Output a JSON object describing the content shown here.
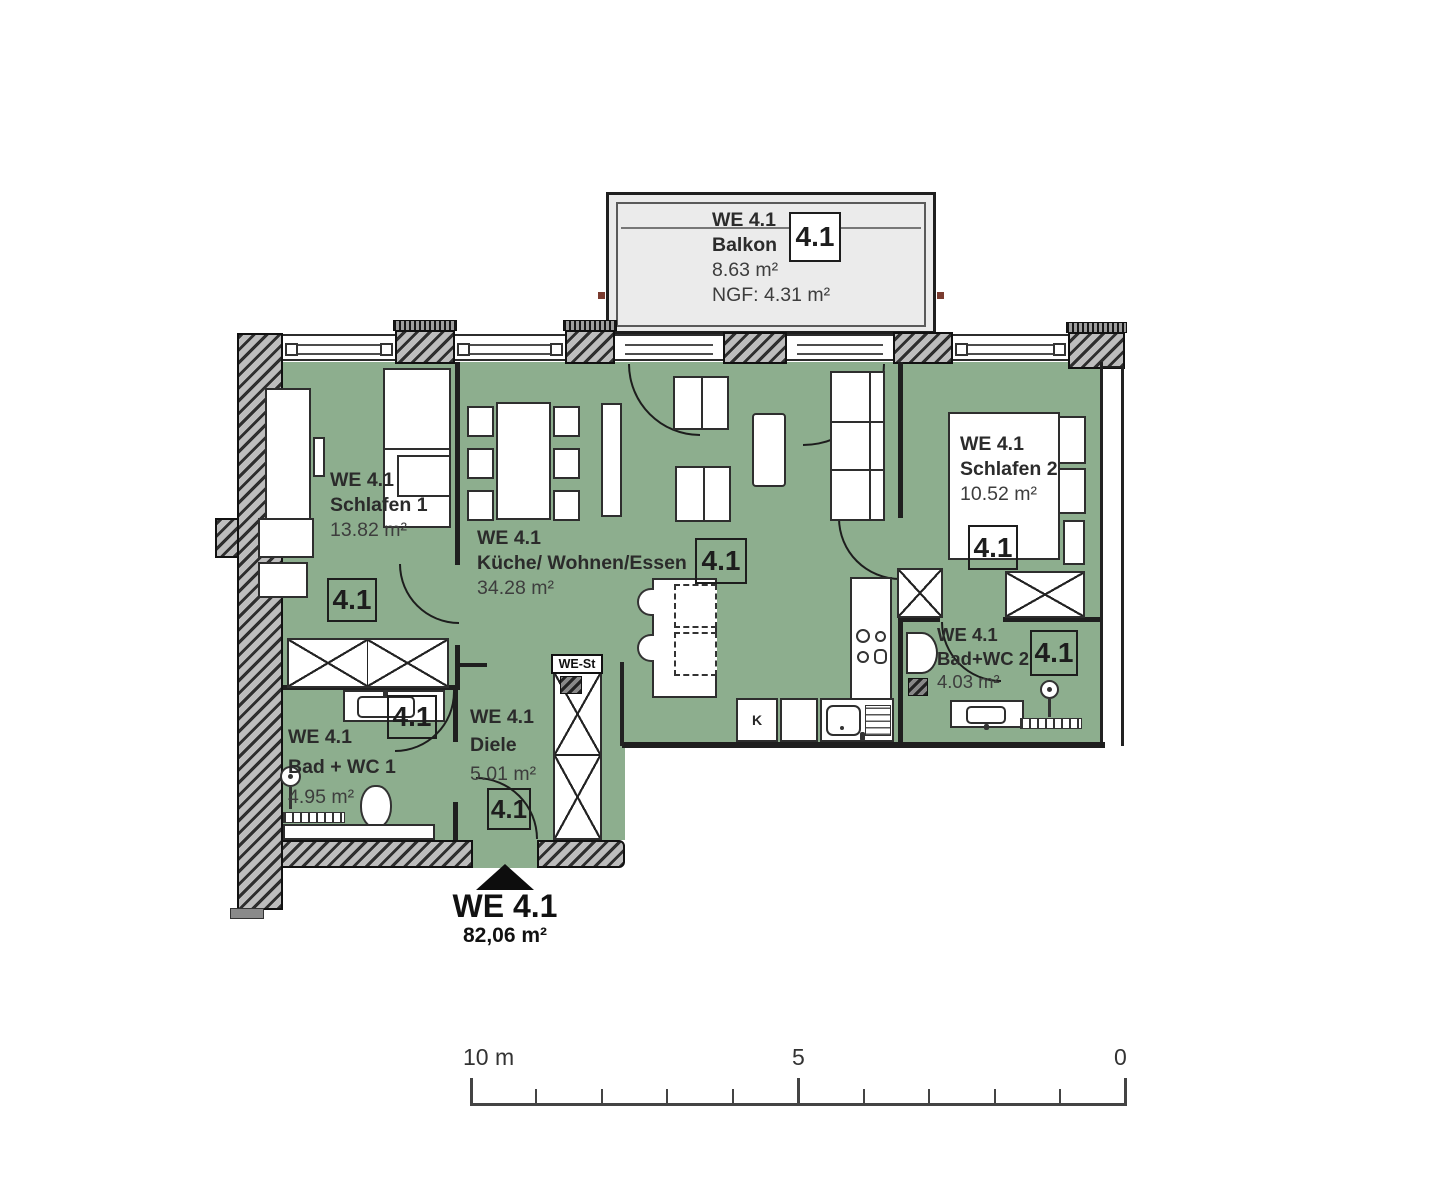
{
  "title": "Wohnung WE 4.1 Grundriss",
  "rooms": [
    {
      "we": "WE 4.1",
      "name": "Balkon",
      "area": "8.63 m²",
      "ngf": "NGF: 4.31 m²",
      "tag": "4.1"
    },
    {
      "we": "WE 4.1",
      "name": "Schlafen 1",
      "area": "13.82 m²",
      "tag": "4.1"
    },
    {
      "we": "WE 4.1",
      "name": "Küche/ Wohnen/Essen",
      "area": "34.28 m²",
      "tag": "4.1"
    },
    {
      "we": "WE 4.1",
      "name": "Schlafen 2",
      "area": "10.52 m²",
      "tag": "4.1"
    },
    {
      "we": "WE 4.1",
      "name": "Bad+WC 2",
      "area": "4.03 m²",
      "tag": "4.1"
    },
    {
      "we": "WE 4.1",
      "name": "Bad + WC 1",
      "area": "4.95 m²",
      "tag": "4.1"
    },
    {
      "we": "WE 4.1",
      "name": "Diele",
      "area": "5.01 m²",
      "tag": "4.1"
    }
  ],
  "entry": {
    "label": "WE 4.1",
    "area": "82,06 m²"
  },
  "annotations": {
    "shaft": "WE-St",
    "fridge": "K"
  },
  "scale": {
    "left": "10 m",
    "middle": "5",
    "right": "0"
  },
  "colors": {
    "room_fill": "#8dae8e",
    "balcony_fill": "#ebebeb",
    "wall": "#1c1c1c"
  }
}
